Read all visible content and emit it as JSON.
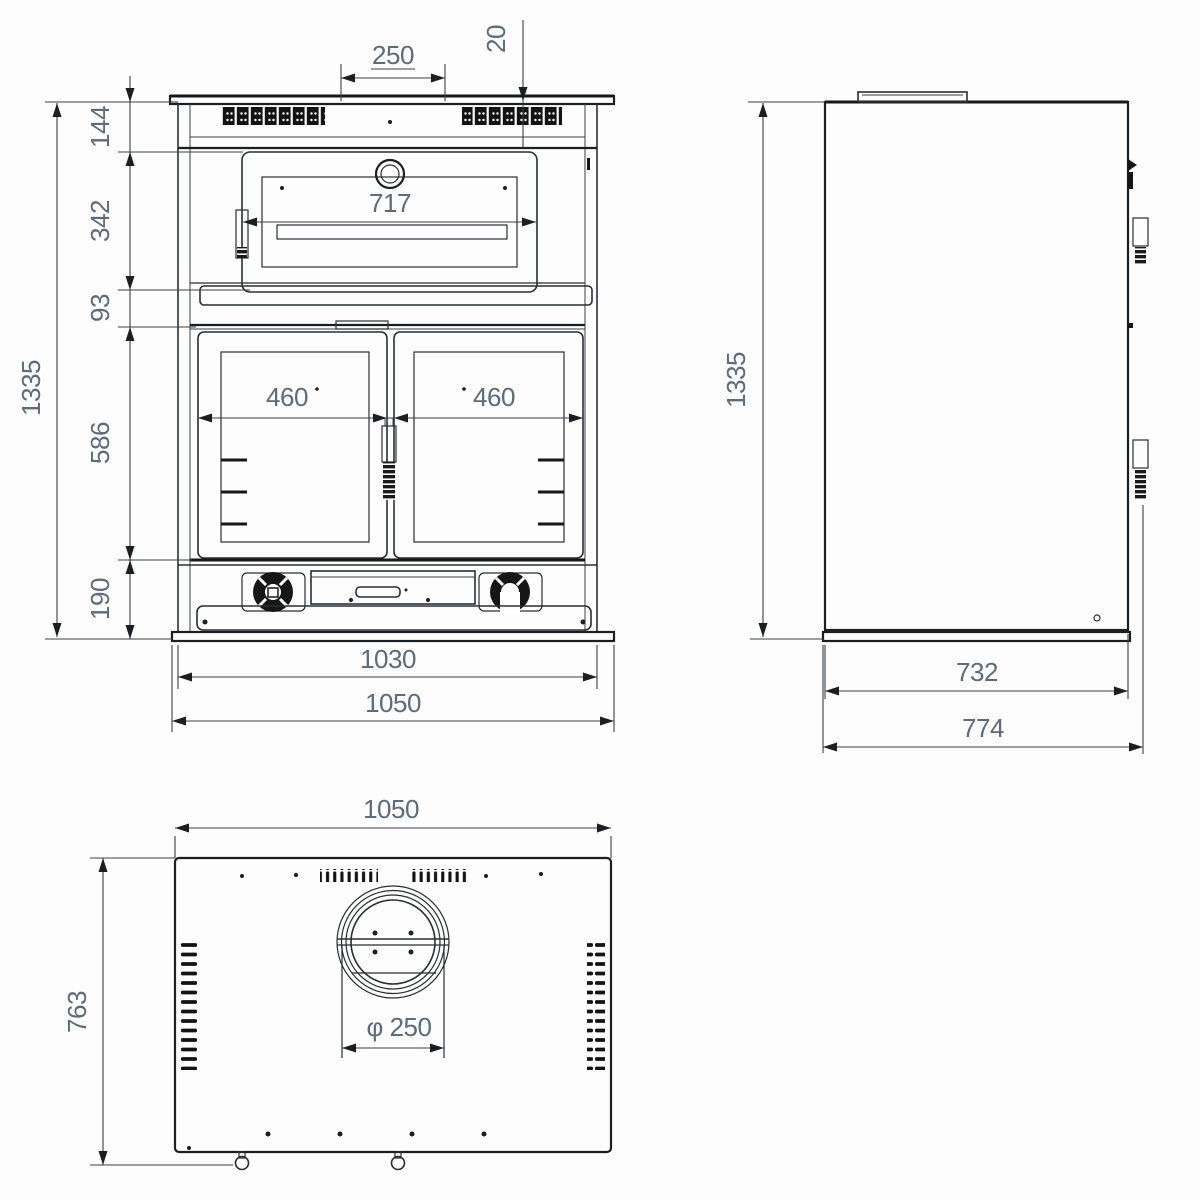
{
  "dims": {
    "front": {
      "hotplate_opening_width": "250",
      "hotplate_thickness": "20",
      "top_section_height": "144",
      "oven_section_height": "342",
      "shelf_gap_height": "93",
      "firebox_section_height": "586",
      "base_section_height": "190",
      "overall_height": "1335",
      "oven_door_width": "717",
      "firebox_left_door_width": "460",
      "firebox_right_door_width": "460",
      "body_width": "1030",
      "overall_width": "1050"
    },
    "side": {
      "overall_height": "1335",
      "body_depth": "732",
      "overall_depth": "774"
    },
    "bottom": {
      "overall_width": "1050",
      "overall_depth": "763",
      "flue_diameter": "φ 250"
    }
  }
}
